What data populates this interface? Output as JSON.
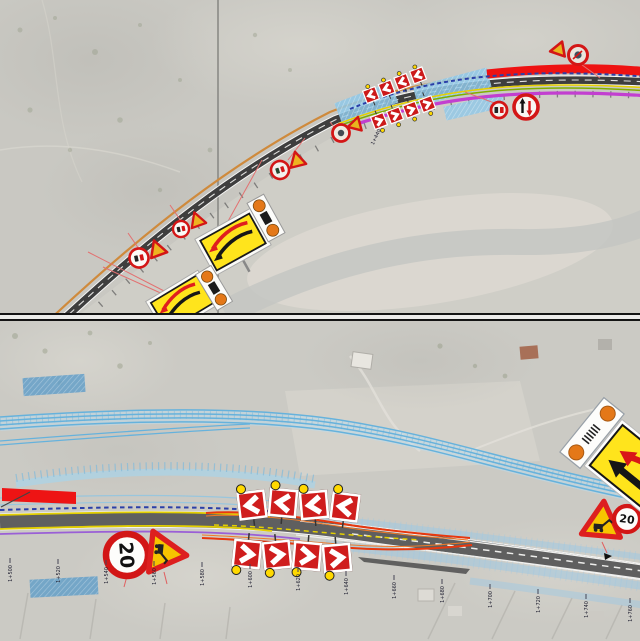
{
  "signs": {
    "speed_limit": "20"
  },
  "stations": {
    "top": [
      "1+440"
    ],
    "bottom": [
      "1+500",
      "1+520",
      "1+540",
      "1+560",
      "1+580",
      "1+600",
      "1+620",
      "1+640",
      "1+660",
      "1+680",
      "1+700",
      "1+720",
      "1+740",
      "1+760"
    ]
  },
  "colors": {
    "aerial_base": "#cac9c3",
    "road_asphalt": "#5a5a5a",
    "closed_lane_red": "#ee1414",
    "diversion_red": "#e8380e",
    "diversion_orange": "#f07a28",
    "marking_yellow": "#e6cf00",
    "utility_blue_dashed": "#2b3fa8",
    "utility_purple": "#9a5fd6",
    "water_blue": "#66b2dc",
    "work_area_blue": "#8fc8e8",
    "sign_ring_red": "#d31616",
    "sign_panel_yellow": "#ffe41c",
    "lamp_orange": "#e47818",
    "lamp_yellow": "#ffd900",
    "outer_edge_orange": "#cf8a3c",
    "magenta_line": "#c23fd0"
  },
  "icons": {
    "chevron-left-icon": "white < chevron on red panel",
    "chevron-right-icon": "white > chevron on red panel",
    "speed-limit-20-icon": "red ring circle with 20",
    "roadworks-triangle-icon": "red triangle, worker glyph",
    "no-overtaking-icon": "red ring, black+red cars",
    "oncoming-priority-icon": "red ring, up/down arrows",
    "lane-crossover-icon": "yellow panel, red+black arrows",
    "barrier-lamp-panel-icon": "white bar with orange lamps"
  }
}
